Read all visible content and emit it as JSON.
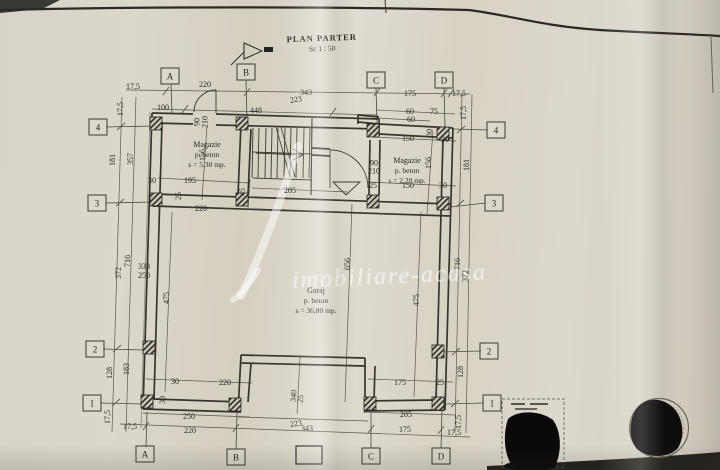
{
  "document": {
    "title": "PLAN PARTER",
    "scale": "Sc 1 : 50",
    "watermark": "imobiliare-acasa"
  },
  "colors": {
    "paper": "#d8d3c7",
    "ink": "#37342c",
    "dim_ink": "#5c564b",
    "stamp_black": "#0a0a0a"
  },
  "rooms": [
    {
      "name": "Magazie",
      "material": "p. beton",
      "area": "s = 5,30 mp.",
      "x": 207,
      "y": 155
    },
    {
      "name": "Magazie",
      "material": "p. beton",
      "area": "s = 2,20 mp.",
      "x": 407,
      "y": 171
    },
    {
      "name": "Garaj",
      "material": "p. beton",
      "area": "s = 36,80 mp.",
      "x": 316,
      "y": 301
    }
  ],
  "door_labels": [
    {
      "lines": [
        "90",
        "210"
      ],
      "x": 201,
      "y": 122,
      "r": -90
    },
    {
      "lines": [
        "90",
        "210"
      ],
      "x": 374,
      "y": 167,
      "r": 0
    }
  ],
  "grid_markers": {
    "top": [
      {
        "label": "A",
        "x": 170,
        "y": 76
      },
      {
        "label": "B",
        "x": 246,
        "y": 72
      },
      {
        "label": "C",
        "x": 376,
        "y": 80
      },
      {
        "label": "D",
        "x": 444,
        "y": 80
      }
    ],
    "bottom": [
      {
        "label": "A",
        "x": 145,
        "y": 454
      },
      {
        "label": "B",
        "x": 236,
        "y": 457
      },
      {
        "label": "C",
        "x": 371,
        "y": 456
      },
      {
        "label": "D",
        "x": 441,
        "y": 456
      }
    ],
    "left": [
      {
        "label": "4",
        "x": 98,
        "y": 127
      },
      {
        "label": "3",
        "x": 97,
        "y": 203
      },
      {
        "label": "2",
        "x": 95,
        "y": 349
      },
      {
        "label": "1",
        "x": 92,
        "y": 403
      }
    ],
    "right": [
      {
        "label": "4",
        "x": 496,
        "y": 130
      },
      {
        "label": "3",
        "x": 494,
        "y": 203
      },
      {
        "label": "2",
        "x": 489,
        "y": 351
      },
      {
        "label": "1",
        "x": 492,
        "y": 403
      }
    ]
  },
  "dimensions": [
    {
      "t": "17,5",
      "x": 133,
      "y": 87
    },
    {
      "t": "220",
      "x": 205,
      "y": 85
    },
    {
      "t": "343",
      "x": 306,
      "y": 93
    },
    {
      "t": "223",
      "x": 296,
      "y": 100,
      "r": -8
    },
    {
      "t": "175",
      "x": 410,
      "y": 94
    },
    {
      "t": "17,5",
      "x": 459,
      "y": 94
    },
    {
      "t": "100",
      "x": 163,
      "y": 108
    },
    {
      "t": "448",
      "x": 256,
      "y": 111
    },
    {
      "t": "60",
      "x": 410,
      "y": 112
    },
    {
      "t": "75",
      "x": 434,
      "y": 112
    },
    {
      "t": "60",
      "x": 411,
      "y": 120
    },
    {
      "t": "30",
      "x": 430,
      "y": 133,
      "r": -90
    },
    {
      "t": "150",
      "x": 408,
      "y": 139
    },
    {
      "t": "30",
      "x": 445,
      "y": 140
    },
    {
      "t": "17,5",
      "x": 121,
      "y": 109,
      "r": -90
    },
    {
      "t": "181",
      "x": 113,
      "y": 160,
      "r": -90
    },
    {
      "t": "357",
      "x": 131,
      "y": 159,
      "r": -90
    },
    {
      "t": "156",
      "x": 203,
      "y": 155,
      "r": -90
    },
    {
      "t": "30",
      "x": 152,
      "y": 181
    },
    {
      "t": "195",
      "x": 190,
      "y": 181
    },
    {
      "t": "25",
      "x": 179,
      "y": 196,
      "r": -90
    },
    {
      "t": "220",
      "x": 201,
      "y": 209
    },
    {
      "t": "45",
      "x": 243,
      "y": 192,
      "r": -90
    },
    {
      "t": "205",
      "x": 290,
      "y": 191
    },
    {
      "t": "25",
      "x": 373,
      "y": 186
    },
    {
      "t": "150",
      "x": 408,
      "y": 186
    },
    {
      "t": "30",
      "x": 443,
      "y": 186
    },
    {
      "t": "17,5",
      "x": 464,
      "y": 113,
      "r": -90
    },
    {
      "t": "181",
      "x": 467,
      "y": 165,
      "r": -90
    },
    {
      "t": "156",
      "x": 429,
      "y": 163,
      "r": -90
    },
    {
      "t": "716",
      "x": 128,
      "y": 261,
      "r": -90
    },
    {
      "t": "372",
      "x": 119,
      "y": 273,
      "r": -90
    },
    {
      "t": "338",
      "x": 144,
      "y": 267
    },
    {
      "t": "250",
      "x": 144,
      "y": 276
    },
    {
      "t": "475",
      "x": 167,
      "y": 298,
      "r": -90
    },
    {
      "t": "656",
      "x": 348,
      "y": 264,
      "r": -90
    },
    {
      "t": "475",
      "x": 417,
      "y": 300,
      "r": -90
    },
    {
      "t": "716",
      "x": 458,
      "y": 264,
      "r": -90
    },
    {
      "t": "372",
      "x": 466,
      "y": 276,
      "r": -90
    },
    {
      "t": "128",
      "x": 110,
      "y": 373,
      "r": -90
    },
    {
      "t": "183",
      "x": 127,
      "y": 369,
      "r": -90
    },
    {
      "t": "30",
      "x": 163,
      "y": 400,
      "r": -90
    },
    {
      "t": "30",
      "x": 175,
      "y": 382
    },
    {
      "t": "220",
      "x": 225,
      "y": 383
    },
    {
      "t": "175",
      "x": 400,
      "y": 383
    },
    {
      "t": "25",
      "x": 440,
      "y": 383
    },
    {
      "t": "128",
      "x": 461,
      "y": 372,
      "r": -90
    },
    {
      "t": "17,5",
      "x": 108,
      "y": 417,
      "r": -90
    },
    {
      "t": "250",
      "x": 189,
      "y": 417
    },
    {
      "t": "205",
      "x": 406,
      "y": 415
    },
    {
      "t": "17,5",
      "x": 459,
      "y": 422,
      "r": -90
    },
    {
      "t": "17,5",
      "x": 130,
      "y": 427
    },
    {
      "t": "220",
      "x": 190,
      "y": 431
    },
    {
      "t": "343",
      "x": 307,
      "y": 429
    },
    {
      "t": "223",
      "x": 296,
      "y": 424,
      "r": -8
    },
    {
      "t": "175",
      "x": 405,
      "y": 430
    },
    {
      "t": "17,5",
      "x": 454,
      "y": 433
    },
    {
      "t": "340",
      "x": 294,
      "y": 396,
      "r": -85
    },
    {
      "t": "25",
      "x": 301,
      "y": 399,
      "r": -85
    }
  ]
}
